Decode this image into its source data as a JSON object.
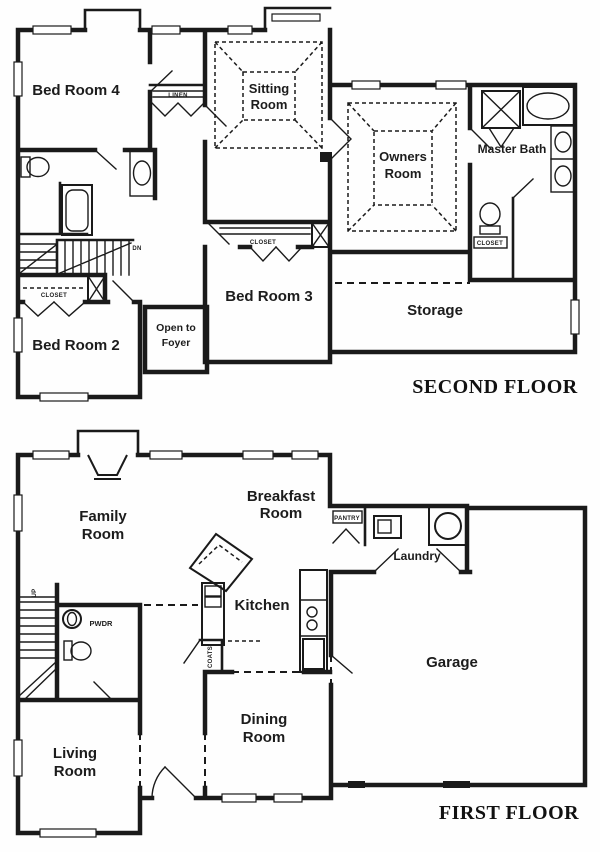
{
  "colors": {
    "background": "#fefefe",
    "ink": "#1a1a1a"
  },
  "second_floor": {
    "title": "SECOND FLOOR",
    "rooms": {
      "bed_room_4": "Bed Room 4",
      "sitting_room": [
        "Sitting",
        "Room"
      ],
      "owners_room": [
        "Owners",
        "Room"
      ],
      "master_bath": "Master Bath",
      "storage": "Storage",
      "bed_room_3": "Bed Room 3",
      "bed_room_2": "Bed Room 2",
      "open_to_foyer": [
        "Open to",
        "Foyer"
      ]
    },
    "labels": {
      "linen": "LINEN",
      "closet_bed3": "CLOSET",
      "closet_bed2": "CLOSET",
      "closet_master": "CLOSET",
      "down": "DN"
    }
  },
  "first_floor": {
    "title": "FIRST FLOOR",
    "rooms": {
      "family_room": [
        "Family",
        "Room"
      ],
      "breakfast_room": [
        "Breakfast",
        "Room"
      ],
      "kitchen": "Kitchen",
      "laundry": "Laundry",
      "garage": "Garage",
      "dining_room": [
        "Dining",
        "Room"
      ],
      "living_room": [
        "Living",
        "Room"
      ]
    },
    "labels": {
      "pantry": "PANTRY",
      "powder": "PWDR",
      "coats": "COATS",
      "up": "UP"
    }
  }
}
